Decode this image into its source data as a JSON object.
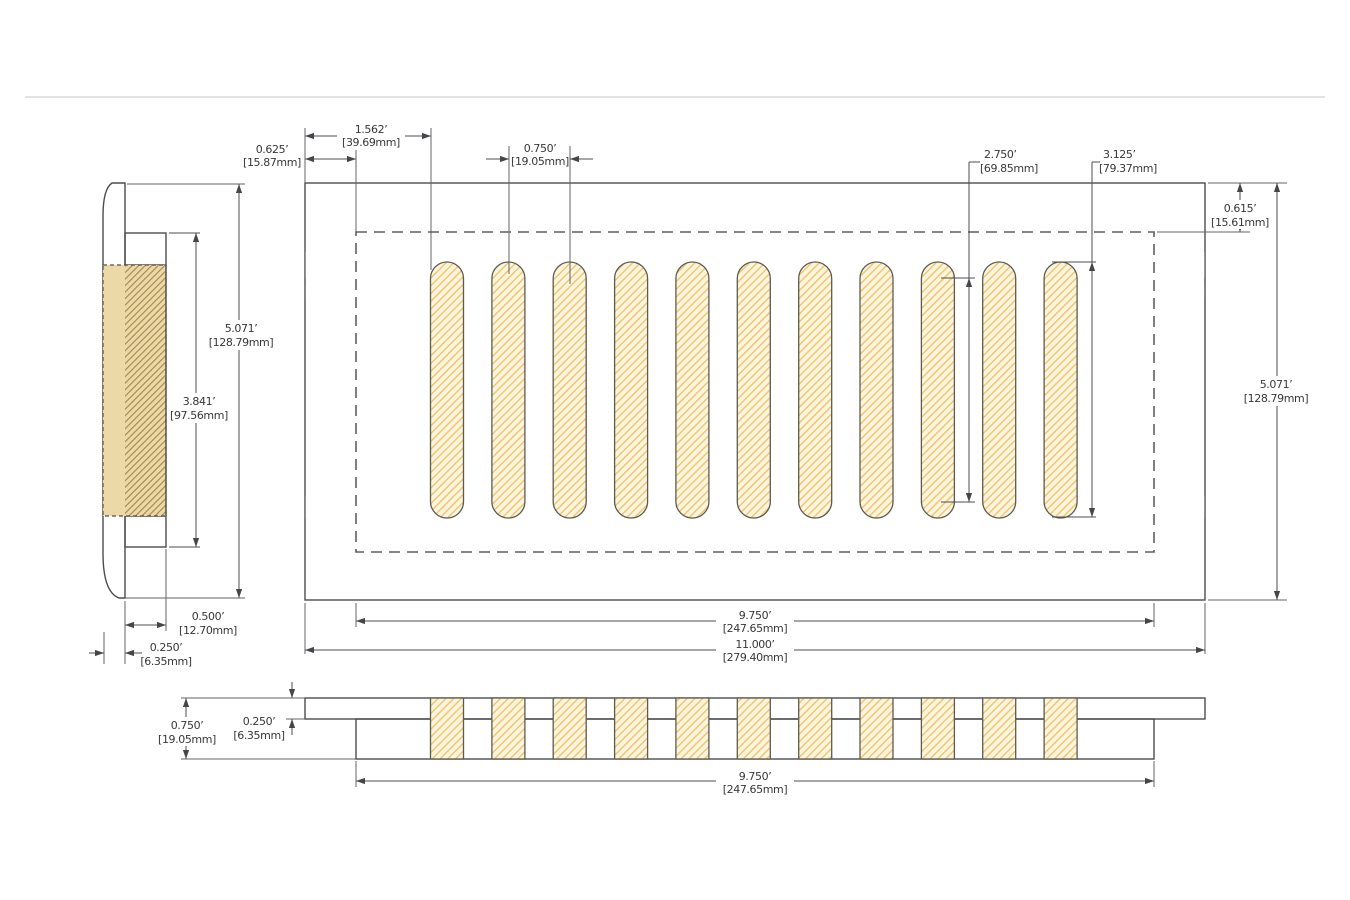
{
  "views": {
    "side": {
      "label": "side-profile-view",
      "dims": {
        "overall_height": {
          "in": "5.071’",
          "mm": "[128.79mm]"
        },
        "duct_length": {
          "in": "3.841’",
          "mm": "[97.56mm]"
        },
        "duct_depth": {
          "in": "0.500’",
          "mm": "[12.70mm]"
        },
        "faceplate_thickness": {
          "in": "0.250’",
          "mm": "[6.35mm]"
        }
      }
    },
    "top": {
      "slot_count": 11,
      "dims": {
        "edge_to_first_slot": {
          "in": "1.562’",
          "mm": "[39.69mm]"
        },
        "edge_to_duct": {
          "in": "0.625’",
          "mm": "[15.87mm]"
        },
        "slot_pitch": {
          "in": "0.750’",
          "mm": "[19.05mm]"
        },
        "slot_inner_length": {
          "in": "2.750’",
          "mm": "[69.85mm]"
        },
        "slot_length": {
          "in": "3.125’",
          "mm": "[79.37mm]"
        },
        "edge_to_duct_vertical": {
          "in": "0.615’",
          "mm": "[15.61mm]"
        },
        "overall_height": {
          "in": "5.071’",
          "mm": "[128.79mm]"
        },
        "duct_width": {
          "in": "9.750’",
          "mm": "[247.65mm]"
        },
        "overall_width": {
          "in": "11.000’",
          "mm": "[279.40mm]"
        }
      }
    },
    "section": {
      "slot_count": 11,
      "dims": {
        "total_thickness": {
          "in": "0.750’",
          "mm": "[19.05mm]"
        },
        "plate_thickness": {
          "in": "0.250’",
          "mm": "[6.35mm]"
        },
        "duct_width": {
          "in": "9.750’",
          "mm": "[247.65mm]"
        }
      }
    }
  },
  "colors": {
    "face_gray": "#c4c6c8",
    "plate_gray": "#c9cbcd",
    "dark_gray": "#8d9093",
    "slot_cream": "#fbf5de",
    "hatch_orange": "#f0c46e",
    "side_tan": "#ecd9a8",
    "side_hatch_brown": "#a98b4f",
    "line_dark": "#4b4d50"
  }
}
